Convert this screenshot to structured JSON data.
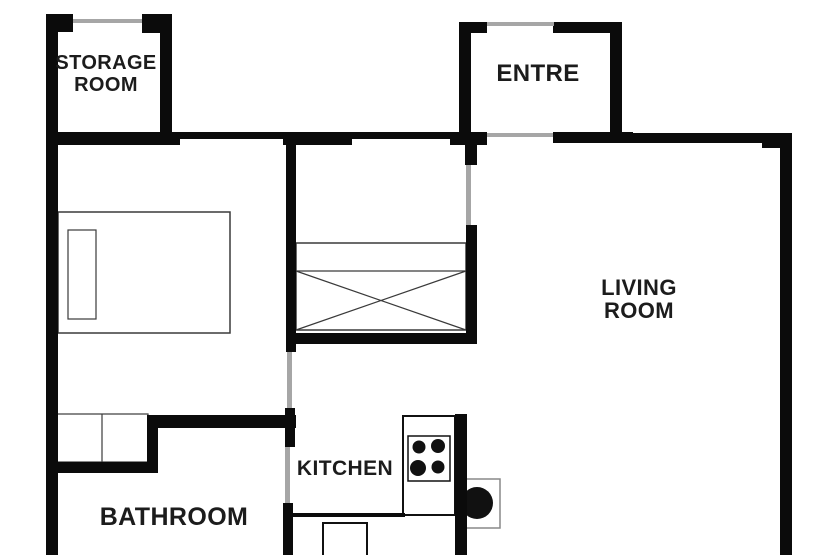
{
  "colors": {
    "background": "#ffffff",
    "wall": "#0b0b0b",
    "opening": "#a6a6a6",
    "furniture_line": "#3a3a3a",
    "appliance_dark": "#111111"
  },
  "rooms": {
    "storage": {
      "lines": [
        "STORAGE",
        "ROOM"
      ]
    },
    "entre": {
      "lines": [
        "ENTRE"
      ]
    },
    "living": {
      "lines": [
        "LIVING",
        "ROOM"
      ]
    },
    "kitchen": {
      "lines": [
        "KITCHEN"
      ]
    },
    "bathroom": {
      "lines": [
        "BATHROOM"
      ]
    }
  },
  "plan": {
    "walls": [
      {
        "name": "outer-left-wall",
        "x": 46,
        "y": 14,
        "w": 12,
        "h": 541
      },
      {
        "name": "storage-top-left-tab",
        "x": 46,
        "y": 14,
        "w": 27,
        "h": 18
      },
      {
        "name": "storage-top-right-tab",
        "x": 142,
        "y": 14,
        "w": 30,
        "h": 19
      },
      {
        "name": "storage-right-wall",
        "x": 160,
        "y": 14,
        "w": 12,
        "h": 120
      },
      {
        "name": "top-wall-west",
        "x": 46,
        "y": 132,
        "w": 134,
        "h": 13
      },
      {
        "name": "top-wall-thin-1",
        "x": 180,
        "y": 132,
        "w": 103,
        "h": 7
      },
      {
        "name": "top-wall-mid",
        "x": 283,
        "y": 132,
        "w": 69,
        "h": 13
      },
      {
        "name": "top-wall-thin-2",
        "x": 352,
        "y": 132,
        "w": 98,
        "h": 7
      },
      {
        "name": "entre-bottom-west-tab",
        "x": 450,
        "y": 132,
        "w": 37,
        "h": 13
      },
      {
        "name": "entre-left-wall",
        "x": 459,
        "y": 22,
        "w": 12,
        "h": 113
      },
      {
        "name": "entre-top-left-tab",
        "x": 459,
        "y": 22,
        "w": 28,
        "h": 11
      },
      {
        "name": "entre-top-right-tab",
        "x": 553,
        "y": 22,
        "w": 69,
        "h": 11
      },
      {
        "name": "entre-right-wall",
        "x": 610,
        "y": 22,
        "w": 12,
        "h": 113
      },
      {
        "name": "entre-bottom-east-tab",
        "x": 553,
        "y": 132,
        "w": 80,
        "h": 11
      },
      {
        "name": "living-top-wall",
        "x": 633,
        "y": 133,
        "w": 159,
        "h": 10
      },
      {
        "name": "living-top-corner",
        "x": 762,
        "y": 133,
        "w": 30,
        "h": 15
      },
      {
        "name": "outer-right-wall",
        "x": 780,
        "y": 133,
        "w": 12,
        "h": 422
      },
      {
        "name": "hall-left-wall",
        "x": 286,
        "y": 136,
        "w": 10,
        "h": 216
      },
      {
        "name": "kitchen-left-wall-upper",
        "x": 285,
        "y": 408,
        "w": 10,
        "h": 39
      },
      {
        "name": "kitchen-left-wall-lower",
        "x": 283,
        "y": 503,
        "w": 10,
        "h": 52
      },
      {
        "name": "hall-right-stub",
        "x": 465,
        "y": 143,
        "w": 12,
        "h": 22
      },
      {
        "name": "hall-right-wall",
        "x": 466,
        "y": 225,
        "w": 11,
        "h": 118
      },
      {
        "name": "hall-bottom-wall",
        "x": 287,
        "y": 333,
        "w": 190,
        "h": 11
      },
      {
        "name": "bathroom-top-wall",
        "x": 148,
        "y": 415,
        "w": 148,
        "h": 13
      },
      {
        "name": "vanity-right-wall",
        "x": 147,
        "y": 415,
        "w": 11,
        "h": 58
      },
      {
        "name": "bathroom-west-wall",
        "x": 57,
        "y": 462,
        "w": 101,
        "h": 11
      },
      {
        "name": "kitchen-island-wall",
        "x": 455,
        "y": 414,
        "w": 12,
        "h": 141
      },
      {
        "name": "counter-bottom-edge",
        "x": 290,
        "y": 513,
        "w": 115,
        "h": 4
      }
    ],
    "openings": [
      {
        "name": "storage-window",
        "x": 73,
        "y": 19,
        "w": 69,
        "h": 4
      },
      {
        "name": "entre-entry-door",
        "x": 487,
        "y": 22,
        "w": 67,
        "h": 4
      },
      {
        "name": "entre-living-opening",
        "x": 487,
        "y": 133,
        "w": 66,
        "h": 4
      },
      {
        "name": "hall-living-door",
        "x": 466,
        "y": 165,
        "w": 5,
        "h": 60
      },
      {
        "name": "bedroom-door",
        "x": 287,
        "y": 352,
        "w": 5,
        "h": 56
      },
      {
        "name": "bathroom-door",
        "x": 285,
        "y": 447,
        "w": 5,
        "h": 56
      }
    ],
    "furniture": [
      {
        "kind": "rect",
        "name": "bed-frame",
        "x": 58,
        "y": 212,
        "w": 172,
        "h": 121,
        "stroke": "#3a3a3a",
        "sw": 1.5,
        "fill": "#ffffff"
      },
      {
        "kind": "rect",
        "name": "bed-pillow",
        "x": 68,
        "y": 230,
        "w": 28,
        "h": 89,
        "stroke": "#3a3a3a",
        "sw": 1.2,
        "fill": "#ffffff"
      },
      {
        "kind": "rect",
        "name": "wardrobe-body",
        "x": 296,
        "y": 243,
        "w": 170,
        "h": 87,
        "stroke": "#3a3a3a",
        "sw": 1.5,
        "fill": "#ffffff"
      },
      {
        "kind": "line",
        "name": "wardrobe-shelf-line",
        "x1": 296,
        "y1": 271,
        "x2": 466,
        "y2": 271,
        "stroke": "#3a3a3a",
        "sw": 1.2
      },
      {
        "kind": "line",
        "name": "wardrobe-cross-1",
        "x1": 296,
        "y1": 271,
        "x2": 466,
        "y2": 330,
        "stroke": "#3a3a3a",
        "sw": 1.2
      },
      {
        "kind": "line",
        "name": "wardrobe-cross-2",
        "x1": 466,
        "y1": 271,
        "x2": 296,
        "y2": 330,
        "stroke": "#3a3a3a",
        "sw": 1.2
      },
      {
        "kind": "rect",
        "name": "bathroom-vanity",
        "x": 57,
        "y": 414,
        "w": 91,
        "h": 48,
        "stroke": "#3a3a3a",
        "sw": 1.2,
        "fill": "#ffffff"
      },
      {
        "kind": "line",
        "name": "vanity-divider",
        "x1": 102,
        "y1": 414,
        "x2": 102,
        "y2": 462,
        "stroke": "#3a3a3a",
        "sw": 1.2
      },
      {
        "kind": "rect",
        "name": "kitchen-counter",
        "x": 403,
        "y": 416,
        "w": 52,
        "h": 99,
        "stroke": "#111111",
        "sw": 2,
        "fill": "#ffffff"
      },
      {
        "kind": "rect",
        "name": "stove-body",
        "x": 408,
        "y": 436,
        "w": 42,
        "h": 45,
        "stroke": "#111111",
        "sw": 1.5,
        "fill": "#ffffff"
      },
      {
        "kind": "circle",
        "name": "stove-burner-1",
        "cx": 419,
        "cy": 447,
        "r": 6.5,
        "fill": "#111111"
      },
      {
        "kind": "circle",
        "name": "stove-burner-2",
        "cx": 438,
        "cy": 446,
        "r": 7,
        "fill": "#111111"
      },
      {
        "kind": "circle",
        "name": "stove-burner-3",
        "cx": 418,
        "cy": 468,
        "r": 8,
        "fill": "#111111"
      },
      {
        "kind": "circle",
        "name": "stove-burner-4",
        "cx": 438,
        "cy": 467,
        "r": 6.5,
        "fill": "#111111"
      },
      {
        "kind": "rect",
        "name": "sink-cabinet",
        "x": 466,
        "y": 479,
        "w": 34,
        "h": 49,
        "stroke": "#888888",
        "sw": 1.5,
        "fill": "#ffffff"
      },
      {
        "kind": "circle",
        "name": "sink-basin",
        "cx": 477,
        "cy": 503,
        "r": 16,
        "fill": "#111111"
      },
      {
        "kind": "path",
        "name": "kitchen-appliance",
        "d": "M323,555 L323,523 L367,523 L367,555",
        "stroke": "#111111",
        "sw": 2
      }
    ]
  }
}
